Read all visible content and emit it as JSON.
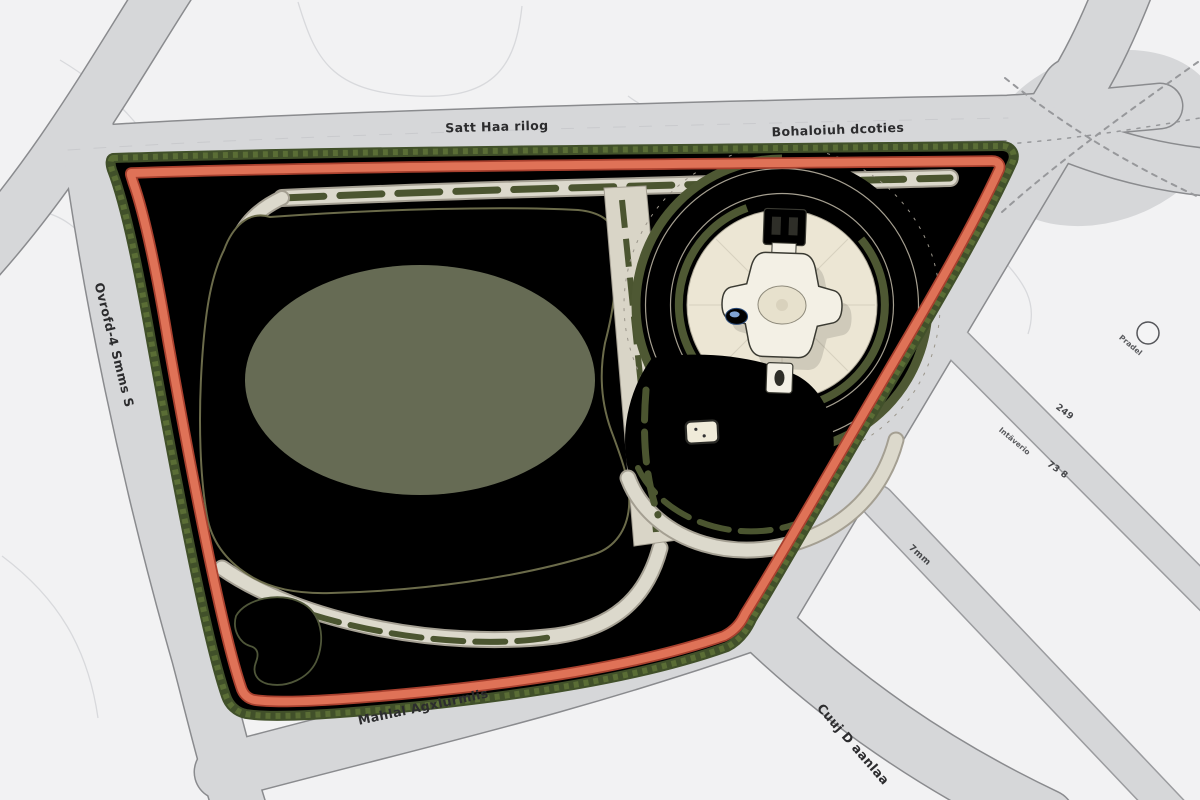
{
  "roads": {
    "top_label": "Satt Haa rilog",
    "top_right_label": "Bohaloiuh dcoties",
    "left_label": "Ovrofd-4 Smms S",
    "bottom_label": "Mahlal Agxlurmlis",
    "bottom_right_label": "Cuuj D aanlaa",
    "street_small_label": "Pradel"
  },
  "annotations": {
    "a249": "249",
    "a73_8": "73 8",
    "intaverio": "Intäverio",
    "a7mm": "7mm"
  },
  "palette": {
    "ground": "#f2f2f3",
    "road_gray": "#d6d7d9",
    "road_outline": "#8a8b8e",
    "street_outline": "#9b9c9f",
    "lawn_green": "#a6ba7a",
    "field_green": "#d8e7ab",
    "field_outline": "#6b6b4a",
    "kidney_green": "#dcedb6",
    "tan": "#e7cda1",
    "track_salmon": "#df7257",
    "track_edge": "#a8402e",
    "hedge_dark": "#41502a",
    "hedge_light": "#5a6d35",
    "plaza_cream": "#eae3d0",
    "stone": "#d8d4c6",
    "stone_edge": "#a49f92",
    "walk_stone": "#dcd9cc",
    "building_white": "#fcfcfd",
    "building_outline": "#47484b",
    "building_shadow": "#b9bbc0",
    "water_blue": "#3c66a3",
    "tree_orange": "#d9a441",
    "tree_green": "#7ca35a",
    "pavilion_cream": "#f3f0e5",
    "pavilion_dark": "#2e2e28"
  }
}
